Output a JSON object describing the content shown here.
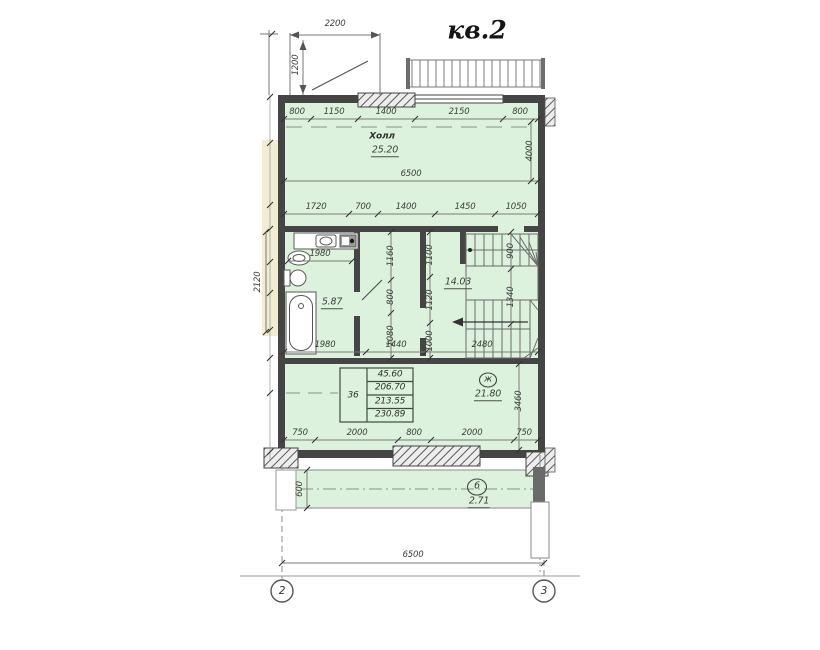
{
  "title": "кв.2",
  "axis_markers": {
    "left": "2",
    "right": "3"
  },
  "rooms": {
    "hall": {
      "name": "Холл",
      "area": "25.20"
    },
    "bathroom": {
      "area": "5.87"
    },
    "stair_hall": {
      "area": "14.03"
    },
    "room": {
      "mark": "ж",
      "area": "21.80"
    },
    "balcony": {
      "mark": "б",
      "area": "2.71"
    }
  },
  "area_table": {
    "apartment_no": "36",
    "values": [
      "45.60",
      "206.70",
      "213.55",
      "230.89"
    ]
  },
  "dimensions": {
    "porch_width": "2200",
    "porch_depth": "1200",
    "top_row": [
      "800",
      "1150",
      "1400",
      "2150",
      "800"
    ],
    "hall_width": "6500",
    "hall_depth": "4000",
    "mid_row": [
      "1720",
      "700",
      "1400",
      "1450",
      "1050"
    ],
    "bath_width": "1980",
    "corridor_col_a": [
      "1160",
      "800",
      "1080"
    ],
    "corridor_col_b": [
      "1100",
      "1120",
      "1000"
    ],
    "stair_col": [
      "900",
      "1340"
    ],
    "lower_row": [
      "1980",
      "1440",
      "2480"
    ],
    "room_depth": "3460",
    "bottom_row": [
      "750",
      "2000",
      "800",
      "2000",
      "750"
    ],
    "balcony_depth": "600",
    "left_side": "2120",
    "overall_width": "6500"
  }
}
